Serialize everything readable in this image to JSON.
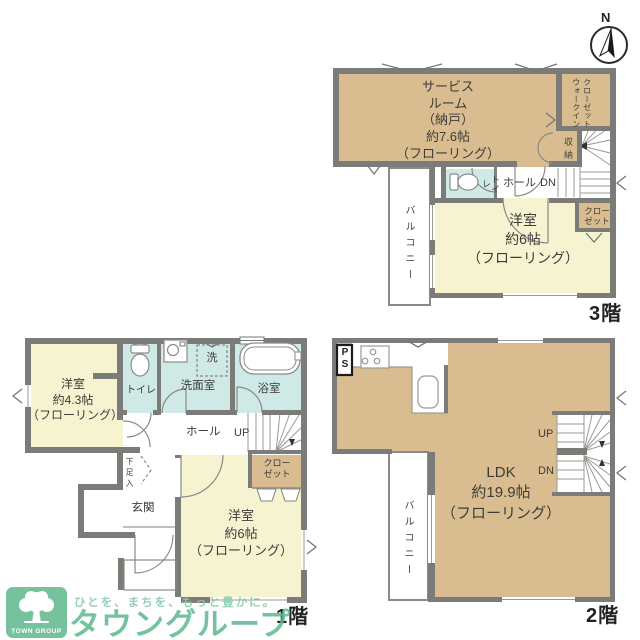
{
  "north": {
    "label": "N"
  },
  "floor3": {
    "service_room": "サービス\nルーム\n（納戸）\n約7.6帖\n（フローリング）",
    "wic": "ウォークイン\nクローゼット",
    "storage": "収納",
    "toilet": "トイレ",
    "hall": "ホール",
    "dn": "DN",
    "bedroom": "洋室\n約6帖\n（フローリング）",
    "closet": "クロー\nゼット",
    "balcony": "バルコニー",
    "floor_label": "3階"
  },
  "floor2": {
    "ps": "P\nS",
    "ldk": "LDK\n約19.9帖\n（フローリング）",
    "up": "UP",
    "dn": "DN",
    "balcony": "バルコニー",
    "floor_label": "2階"
  },
  "floor1": {
    "bedroom_small": "洋室\n約4.3帖\n（フローリング）",
    "toilet": "トイレ",
    "washer": "洗",
    "washroom": "洗面室",
    "bathroom": "浴室",
    "hall": "ホール",
    "up": "UP",
    "closet": "クロー\nゼット",
    "shoe": "下足入",
    "entrance": "玄関",
    "bedroom": "洋室\n約6帖\n（フローリング）",
    "floor_label": "1階"
  },
  "logo": {
    "tagline": "ひとを、まちを、もっと豊かに。",
    "brand": "タウングループ",
    "box_text": "TOWN GROUP"
  },
  "palette": {
    "wall": "#7b7b77",
    "room_tan": "#d9bd90",
    "room_cream": "#f6f3d1",
    "room_blue": "#cfe9e6",
    "brand_green": "#5cb88d"
  }
}
